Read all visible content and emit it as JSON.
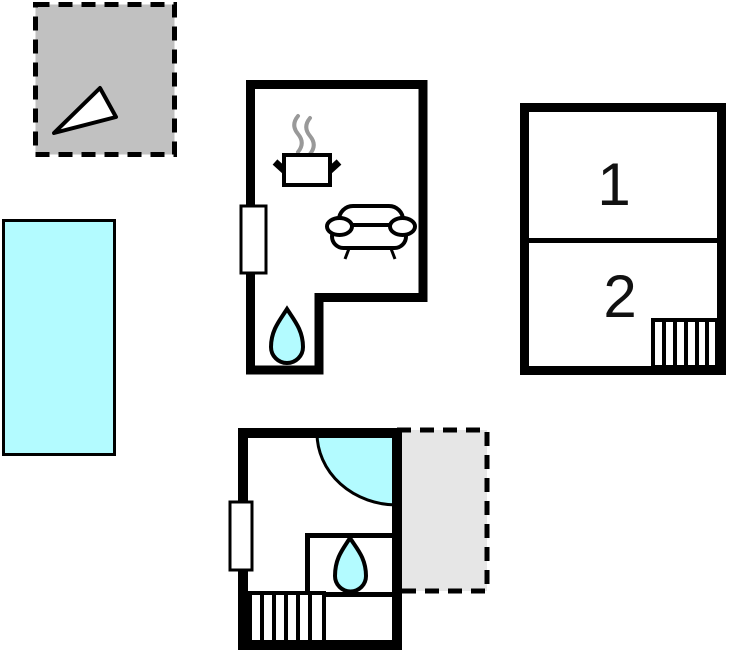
{
  "floorplan": {
    "type": "vacation-home-floor-plan",
    "rooms": {
      "room1_label": "1",
      "room2_label": "2"
    },
    "colors": {
      "wall": "#000000",
      "water": "#b3fbff",
      "upper_terrace_fill": "#c1c1c1",
      "lower_terrace_fill": "#e6e6e6",
      "steam": "#999999",
      "floor": "#ffffff",
      "background": "#ffffff"
    },
    "icons": [
      "north-arrow-icon",
      "pool",
      "window-marker",
      "stove-icon",
      "steam-icon",
      "sofa-icon",
      "water-drop-icon",
      "corner-shower",
      "stairs-icon",
      "terrace-dashed"
    ]
  }
}
